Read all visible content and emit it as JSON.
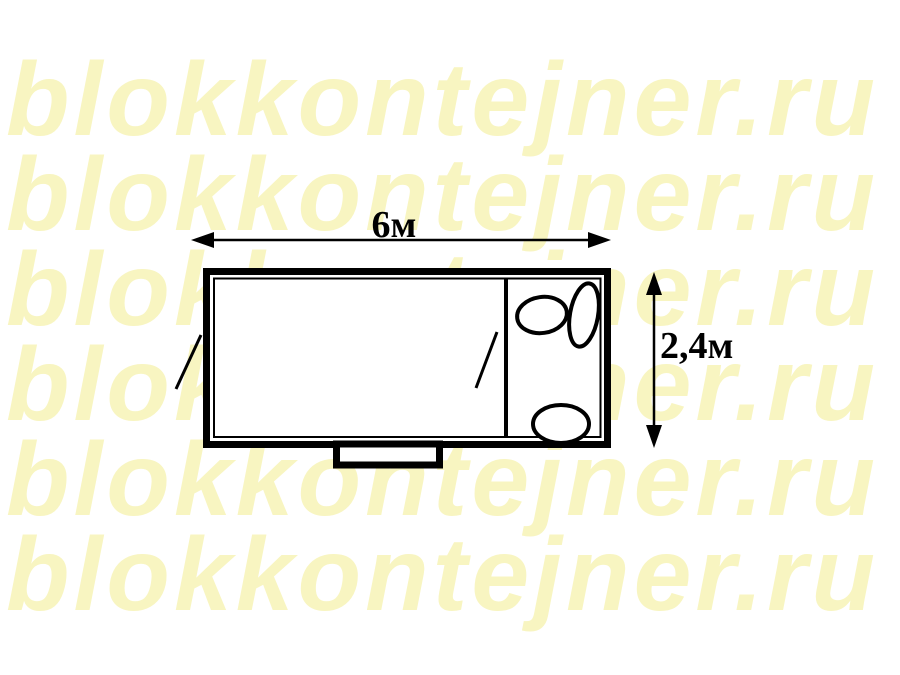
{
  "watermark": {
    "text": "blokkontejner.ru",
    "color": "#f8f5c1",
    "rows": 6
  },
  "plan": {
    "length_dimension_label": "6м",
    "width_dimension_label": "2,4м",
    "line_color": "#000000",
    "background_color": "#ffffff",
    "fixture_icons": [
      "toilet-icon",
      "washbasin-icon"
    ]
  }
}
